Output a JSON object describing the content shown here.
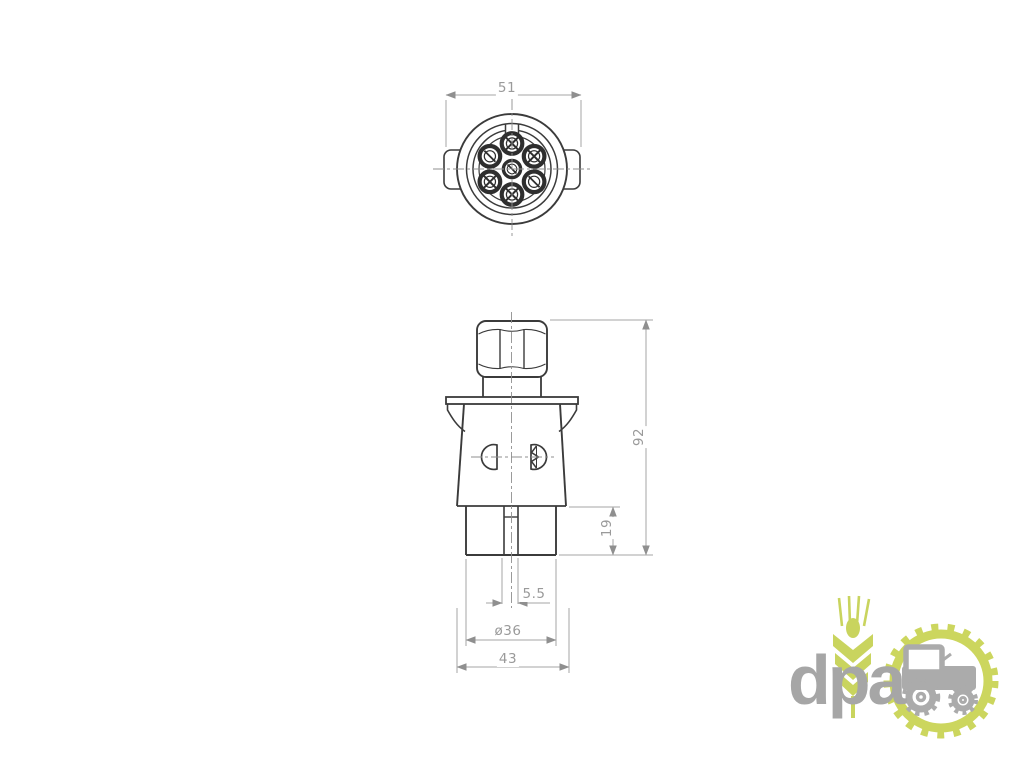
{
  "drawing": {
    "title_hint": "7-pin trailer plug technical drawing",
    "line_color": "#3b3b3b",
    "dim_color": "#9a9a9a",
    "dimensions": {
      "top_width": "51",
      "overall_height": "92",
      "barrel_height": "19",
      "slot_width": "5.5",
      "barrel_diameter": "ø36",
      "flange_width": "43"
    }
  },
  "logo": {
    "text": "dpa",
    "text_color": "#a6a6a6",
    "accent_color": "#c9d45e",
    "icons": [
      "wheat-icon",
      "gear-ring-icon",
      "tractor-icon"
    ]
  }
}
